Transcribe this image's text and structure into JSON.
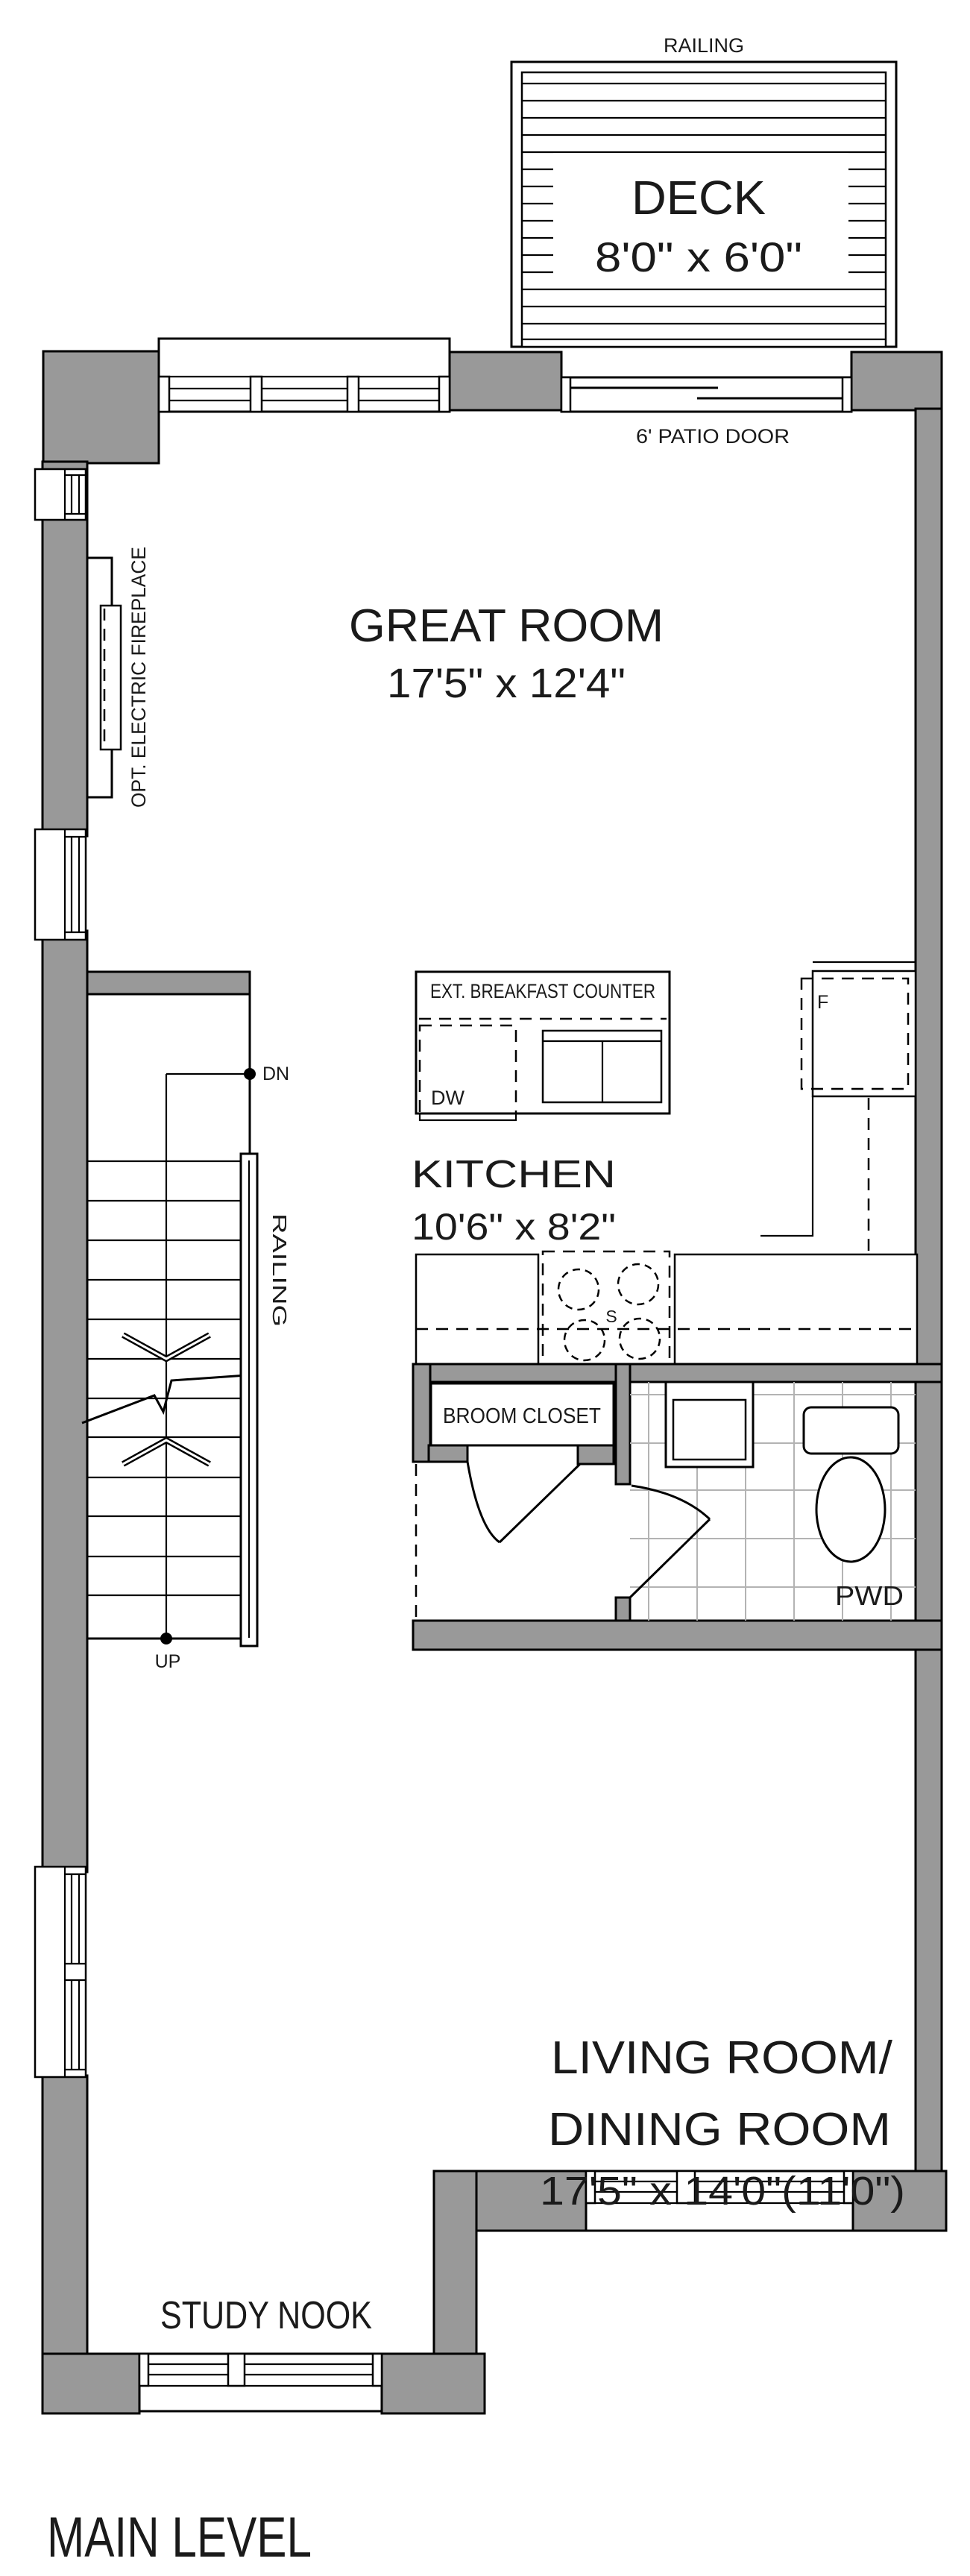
{
  "plan": {
    "level_label": "MAIN LEVEL",
    "colors": {
      "wall": "#999999",
      "line": "#000000",
      "tile_line": "#b3b3b3",
      "background": "#ffffff"
    },
    "deck": {
      "railing_label": "RAILING",
      "name": "DECK",
      "dims": "8'0\" x 6'0\""
    },
    "patio_door_label": "6' PATIO DOOR",
    "great_room": {
      "name": "GREAT ROOM",
      "dims": "17'5\" x 12'4\""
    },
    "fireplace_label": "OPT. ELECTRIC FIREPLACE",
    "kitchen": {
      "name": "KITCHEN",
      "dims": "10'6\" x 8'2\"",
      "island_label": "EXT. BREAKFAST COUNTER",
      "dishwasher_label": "DW",
      "fridge_label": "F",
      "stove_label": "S"
    },
    "stairs": {
      "down_label": "DN",
      "up_label": "UP",
      "railing_label": "RAILING"
    },
    "broom_closet_label": "BROOM CLOSET",
    "powder_room_label": "PWD",
    "living_dining": {
      "name_line1": "LIVING ROOM/",
      "name_line2": "DINING ROOM",
      "dims": "17'5\" x 14'0\"(11'0\")"
    },
    "study_nook_label": "STUDY NOOK"
  }
}
